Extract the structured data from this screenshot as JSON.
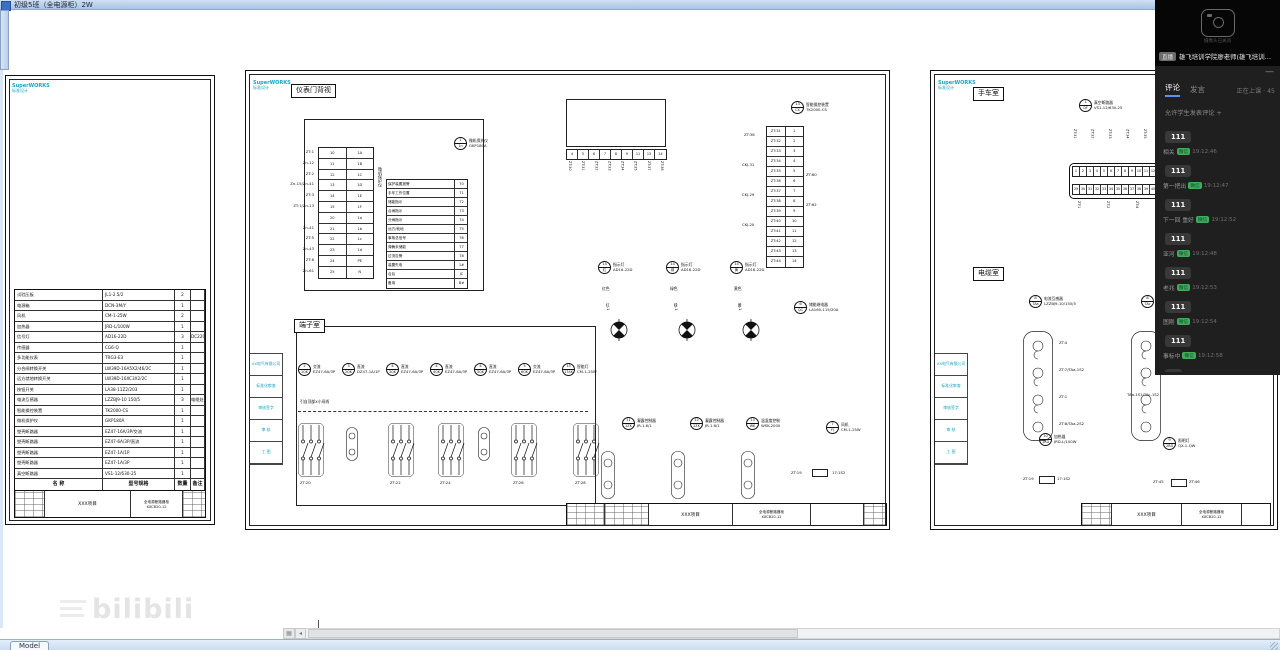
{
  "titlebar": {
    "text": "初级5班（全电源柜）2W"
  },
  "statusbar": {
    "model_tab": "Model"
  },
  "watermark": {
    "text": "bilibili"
  },
  "stream": {
    "video_caption": "摄像头已关闭",
    "title_chip": "直播",
    "title": "雄飞培训学院廖老师(雄飞培训…",
    "tabs": {
      "comments": "评论",
      "speak": "发言"
    },
    "status": "正在上课 · 45",
    "notice": "允许学生发表评论 +",
    "badge": "微信",
    "minimize": "—",
    "messages": [
      {
        "user": "",
        "time": "",
        "text": "111"
      },
      {
        "user": "相关",
        "time": "19:12:46",
        "text": "111"
      },
      {
        "user": "第一把出",
        "time": "19:12:47",
        "text": "111"
      },
      {
        "user": "下一回 重好",
        "time": "19:12:52",
        "text": "111"
      },
      {
        "user": "亚河",
        "time": "19:12:48",
        "text": "111"
      },
      {
        "user": "老兆",
        "time": "19:12:53",
        "text": "111"
      },
      {
        "user": "图刚",
        "time": "19:12:54",
        "text": "111"
      },
      {
        "user": "事标中",
        "time": "19:12:58",
        "text": "1"
      }
    ]
  },
  "sheets": {
    "left": {
      "logo": "SuperWORKS",
      "logo_sub": "标准设计",
      "bom": {
        "headers_row": [
          [
            "名  称",
            "型号规格",
            "数量",
            "备注"
          ]
        ],
        "rows": [
          [
            "试验压板",
            "JL1-2.5/2",
            "2",
            ""
          ],
          [
            "电源箱",
            "DCN-3M/Y",
            "1",
            ""
          ],
          [
            "风机",
            "CM-1-25W",
            "2",
            ""
          ],
          [
            "加热器",
            "JRD-L/100W",
            "1",
            ""
          ],
          [
            "信号灯",
            "AD16-22D",
            "3",
            "DC220V"
          ],
          [
            "传感器",
            "CG6-Q",
            "1",
            ""
          ],
          [
            "多功能仪表",
            "TRG3-E3",
            "1",
            ""
          ],
          [
            "分合闸转换开关",
            "LW39D-16A5X2/46/2C",
            "1",
            ""
          ],
          [
            "远方就地转换开关",
            "LW39D-16XC3X2/2C",
            "1",
            ""
          ],
          [
            "按钮开关",
            "LA38-11Z2/203",
            "1",
            ""
          ],
          [
            "电流互感器",
            "LZZBJ9-10 150/5",
            "3",
            "电缆处安装"
          ],
          [
            "智能操控装置",
            "TK2000-CS",
            "1",
            ""
          ],
          [
            "微机保护仪",
            "GKP180A",
            "1",
            ""
          ],
          [
            "塑壳断路器",
            "EZ47-16A/3P/交流",
            "1",
            ""
          ],
          [
            "塑壳断路器",
            "EZ47-6A/3P/直流",
            "1",
            ""
          ],
          [
            "塑壳断路器",
            "EZ47-1A/1P",
            "1",
            ""
          ],
          [
            "塑壳断路器",
            "EZ47-1A/3P",
            "1",
            ""
          ],
          [
            "真空断路器",
            "VS1-12/630-25",
            "1",
            ""
          ]
        ]
      },
      "title_block": {
        "project": "XXX项目",
        "drawing": "全电源断路器柜",
        "number": "XXCB20-12"
      }
    },
    "middle": {
      "logo": "SuperWORKS",
      "logo_sub": "标准设计",
      "room1": "仪表门背视",
      "room2": "端子室",
      "bus_note": "引自顶部X小母线",
      "vert_label": "微机保护仪",
      "door_wire_labels": [
        "ZT:1",
        "Zn-12",
        "ZT:2",
        "Zn-15/Zn-41",
        "ZT:3",
        "ZT:1/Zn-13",
        "",
        "Zn-41",
        "ZT:5",
        "Zn-43",
        "ZT:6",
        "Zn-61"
      ],
      "door_terminals": [
        [
          "10",
          "1A"
        ],
        [
          "11",
          "1B"
        ],
        [
          "12",
          "1C"
        ],
        [
          "13",
          "1D"
        ],
        [
          "14",
          "1E"
        ],
        [
          "15",
          "1F"
        ],
        [
          "20",
          "1a"
        ],
        [
          "21",
          "1b"
        ],
        [
          "22",
          "1c"
        ],
        [
          "23",
          "1d"
        ],
        [
          "24",
          "PE"
        ],
        [
          "25",
          "N"
        ]
      ],
      "signal_rows": [
        [
          "保护装置报警",
          "70"
        ],
        [
          "手车工作位置",
          "71"
        ],
        [
          "储能指示",
          "72"
        ],
        [
          "合闸指示",
          "73"
        ],
        [
          "分闸指示",
          "74"
        ],
        [
          "远方/就地",
          "75"
        ],
        [
          "事故总信号",
          "76"
        ],
        [
          "弹簧未储能",
          "77"
        ],
        [
          "过流告警",
          "78"
        ],
        [
          "装置失电",
          "1#"
        ],
        [
          "合后",
          "JC"
        ],
        [
          "备用",
          "B#"
        ]
      ],
      "display_cells": [
        "4",
        "5",
        "6",
        "7",
        "8",
        "9",
        "11",
        "13",
        "14"
      ],
      "display_vlabels": [
        "ZT:30",
        "ZT:31",
        "ZT:32",
        "ZT:33",
        "ZT:34",
        "ZT:35",
        "ZT:37",
        "ZT:38"
      ],
      "vtable_rows": [
        [
          "ZT:31",
          "1"
        ],
        [
          "ZT:32",
          "2"
        ],
        [
          "ZT:33",
          "3"
        ],
        [
          "ZT:34",
          "4"
        ],
        [
          "ZT:35",
          "5"
        ],
        [
          "ZT:36",
          "6"
        ],
        [
          "ZT:37",
          "7"
        ],
        [
          "ZT:38",
          "8"
        ],
        [
          "ZT:39",
          "9"
        ],
        [
          "ZT:40",
          "10"
        ],
        [
          "ZT:41",
          "11"
        ],
        [
          "ZT:42",
          "12"
        ],
        [
          "ZT:43",
          "13"
        ],
        [
          "ZT:44",
          "14"
        ]
      ],
      "vtable_side": [
        {
          "x": 498,
          "y": 62,
          "t": "ZT:36"
        },
        {
          "x": 496,
          "y": 92,
          "t": "CKJ-31"
        },
        {
          "x": 496,
          "y": 122,
          "t": "CKJ-29"
        },
        {
          "x": 496,
          "y": 152,
          "t": "CKJ-20"
        },
        {
          "x": 560,
          "y": 102,
          "t": "ZT:60"
        },
        {
          "x": 560,
          "y": 132,
          "t": "ZT:62"
        }
      ],
      "circles": [
        {
          "x": 208,
          "y": 66,
          "n": "1",
          "s": "1n",
          "a": "微机保护仪",
          "b": "GKP180A"
        },
        {
          "x": 545,
          "y": 30,
          "n": "13",
          "s": "CX",
          "a": "智能操控装置",
          "b": "TK2000-CS"
        },
        {
          "x": 352,
          "y": 190,
          "n": "14",
          "s": "红",
          "a": "指示灯",
          "b": "AD16-22D"
        },
        {
          "x": 420,
          "y": 190,
          "n": "14",
          "s": "绿",
          "a": "指示灯",
          "b": "AD16-22D"
        },
        {
          "x": 484,
          "y": 190,
          "n": "14",
          "s": "黄",
          "a": "指示灯",
          "b": "AD16-22D"
        },
        {
          "x": 548,
          "y": 230,
          "n": "6",
          "s": "QC",
          "a": "储能继电器",
          "b": "LA160-115/20A"
        },
        {
          "x": 376,
          "y": 346,
          "n": "11",
          "s": "1ZK",
          "a": "凝露控制器",
          "b": "JR-1.6/1"
        },
        {
          "x": 444,
          "y": 346,
          "n": "12",
          "s": "2ZK",
          "a": "凝露控制器",
          "b": "JR-1.6/1"
        },
        {
          "x": 500,
          "y": 346,
          "n": "13",
          "s": "WK",
          "a": "温湿度控制",
          "b": "WSK-2000"
        },
        {
          "x": 580,
          "y": 350,
          "n": "7",
          "s": "FJ",
          "a": "风机",
          "b": "CM-1-25W"
        }
      ],
      "breakers": [
        {
          "x": 52,
          "y": 292,
          "n": "2",
          "s": "1QK",
          "a": "交流",
          "b": "EZ47-6A/3P"
        },
        {
          "x": 96,
          "y": 292,
          "n": "3",
          "s": "2QK",
          "a": "直流",
          "b": "DZ47-1A/1P"
        },
        {
          "x": 140,
          "y": 292,
          "n": "4",
          "s": "3QK",
          "a": "直流",
          "b": "EZ47-6A/3P"
        },
        {
          "x": 184,
          "y": 292,
          "n": "4",
          "s": "4QK",
          "a": "直流",
          "b": "EZ47-6A/3P"
        },
        {
          "x": 228,
          "y": 292,
          "n": "4",
          "s": "5QK",
          "a": "直流",
          "b": "EZ47-6A/3P"
        },
        {
          "x": 272,
          "y": 292,
          "n": "5",
          "s": "6QK",
          "a": "交流",
          "b": "EZ47-6A/3P"
        },
        {
          "x": 316,
          "y": 292,
          "n": "15",
          "s": "17AK",
          "a": "智能灯",
          "b": "CM-1-25W"
        }
      ],
      "misc_labels": [
        {
          "x": 356,
          "y": 216,
          "t": "红色",
          "c": 0
        },
        {
          "x": 424,
          "y": 216,
          "t": "绿色",
          "c": 0
        },
        {
          "x": 488,
          "y": 216,
          "t": "黄色",
          "c": 0
        },
        {
          "x": 360,
          "y": 232,
          "t": "红-1",
          "v": 1
        },
        {
          "x": 428,
          "y": 232,
          "t": "绿-1",
          "v": 1
        },
        {
          "x": 492,
          "y": 232,
          "t": "黄-1",
          "v": 1
        },
        {
          "x": 54,
          "y": 410,
          "t": "ZT:20"
        },
        {
          "x": 144,
          "y": 410,
          "t": "ZT:22"
        },
        {
          "x": 194,
          "y": 410,
          "t": "ZT:24"
        },
        {
          "x": 267,
          "y": 410,
          "t": "ZT:26"
        },
        {
          "x": 329,
          "y": 410,
          "t": "ZT:28"
        },
        {
          "x": 352,
          "y": 432,
          "t": "1n-b2"
        },
        {
          "x": 422,
          "y": 432,
          "t": "1a-b4"
        },
        {
          "x": 492,
          "y": 432,
          "t": "ZX-6"
        },
        {
          "x": 545,
          "y": 400,
          "t": "ZT:19"
        },
        {
          "x": 586,
          "y": 400,
          "t": "17:1S2"
        }
      ],
      "title_block": {
        "project": "XXX项目",
        "drawing": "全电源断路器柜",
        "number": "XXCB20-12"
      },
      "side_fields": [
        "XX电气有限公司",
        "标准化审查",
        "审核签字",
        "审  核",
        "工  图"
      ]
    },
    "right": {
      "logo": "SuperWORKS",
      "logo_sub": "标准设计",
      "room1": "手车室",
      "room2": "电缆室",
      "strip_row1": [
        "1",
        "2",
        "3",
        "4",
        "5",
        "6",
        "7",
        "8",
        "9",
        "10",
        "11",
        "12",
        "13",
        "14",
        "15",
        "16",
        "17",
        "18",
        "19",
        "20",
        "21",
        "22",
        "23",
        "24",
        "25",
        "26",
        "27",
        "28"
      ],
      "strip_row2": [
        "29",
        "30",
        "31",
        "32",
        "33",
        "34",
        "35",
        "36",
        "37",
        "38",
        "39",
        "40",
        "41",
        "42",
        "43",
        "44",
        "45",
        "46",
        "47",
        "48",
        "49",
        "50",
        "51",
        "52",
        "53",
        "54",
        "55",
        "56"
      ],
      "strip_vlabels_top": [
        "ZT:31",
        "ZT:32",
        "ZT:33",
        "ZT:34",
        "ZT:35",
        "ZT:36",
        "ZT:37",
        "ZT:38",
        "ZT:39",
        "ZT:40",
        "ZT:41",
        "ZT:42"
      ],
      "strip_vlabels_bottom": [
        "ZT:1",
        "ZT:2",
        "ZT:4",
        "ZT:6",
        "ZT:8"
      ],
      "circles": [
        {
          "x": 148,
          "y": 28,
          "n": "1",
          "s": "QF",
          "a": "真空断路器",
          "b": "VS1-12/630-25"
        },
        {
          "x": 98,
          "y": 224,
          "n": "8",
          "s": "TAa",
          "a": "电流互感器",
          "b": "LZZBJ9-10/150/5"
        },
        {
          "x": 210,
          "y": 224,
          "n": "8",
          "s": "TAc",
          "a": "电流互感器",
          "b": "LZZBJ9-10/150/5"
        },
        {
          "x": 108,
          "y": 362,
          "n": "10",
          "s": "1RD",
          "a": "加热器",
          "b": "JRD-L/100W"
        },
        {
          "x": 232,
          "y": 366,
          "n": "9",
          "s": "2RD",
          "a": "照明灯",
          "b": "QX-1-QW"
        }
      ],
      "ct_labels": [
        {
          "x": 128,
          "y": 270,
          "t": "ZT:4"
        },
        {
          "x": 128,
          "y": 297,
          "t": "ZT:7/TAa-1S2"
        },
        {
          "x": 128,
          "y": 324,
          "t": "ZT:1"
        },
        {
          "x": 128,
          "y": 351,
          "t": "ZT:8/TAa-2S2"
        },
        {
          "x": 196,
          "y": 322,
          "t": "TAa-1S1/TAc-1S2"
        },
        {
          "x": 92,
          "y": 406,
          "t": "ZT:19"
        },
        {
          "x": 126,
          "y": 406,
          "t": "17:1S2"
        },
        {
          "x": 222,
          "y": 409,
          "t": "ZT:45"
        },
        {
          "x": 258,
          "y": 409,
          "t": "ZT:46"
        }
      ],
      "title_block": {
        "project": "XXX项目",
        "drawing": "全电源断路器柜",
        "number": "XXCB20-12"
      },
      "side_fields": [
        "XX电气有限公司",
        "标准化审查",
        "审核签字",
        "审  核",
        "工  图"
      ]
    }
  }
}
